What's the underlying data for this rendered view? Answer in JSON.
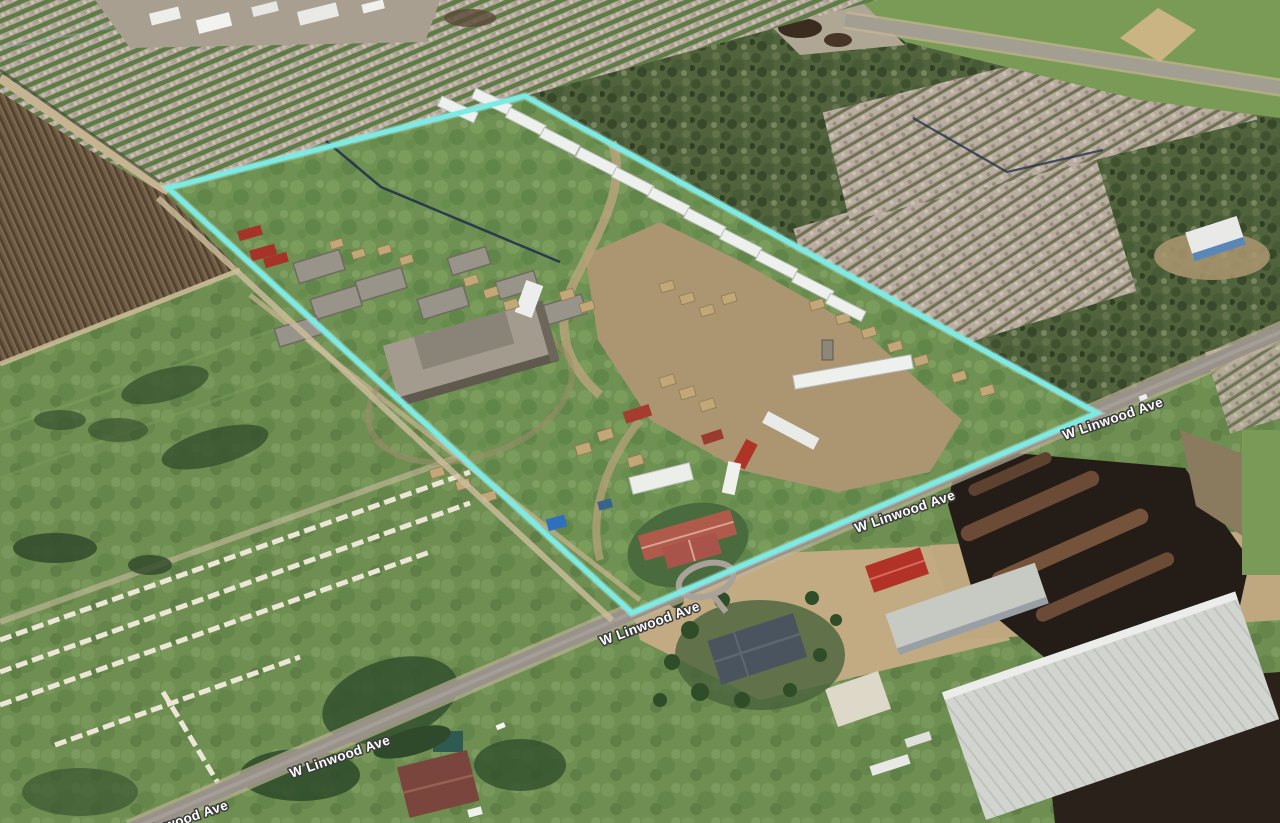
{
  "boundary": {
    "color": "#7CEBE5",
    "glow": "#BDF6F2"
  },
  "labels": {
    "color": "#ffffff",
    "halo": "#3d3d3d",
    "road": [
      {
        "text": "W Linwood Ave"
      },
      {
        "text": "W Linwood Ave"
      },
      {
        "text": "W Linwood Ave"
      },
      {
        "text": "W Linwood Ave"
      },
      {
        "text": "W Linwood Ave"
      }
    ]
  }
}
